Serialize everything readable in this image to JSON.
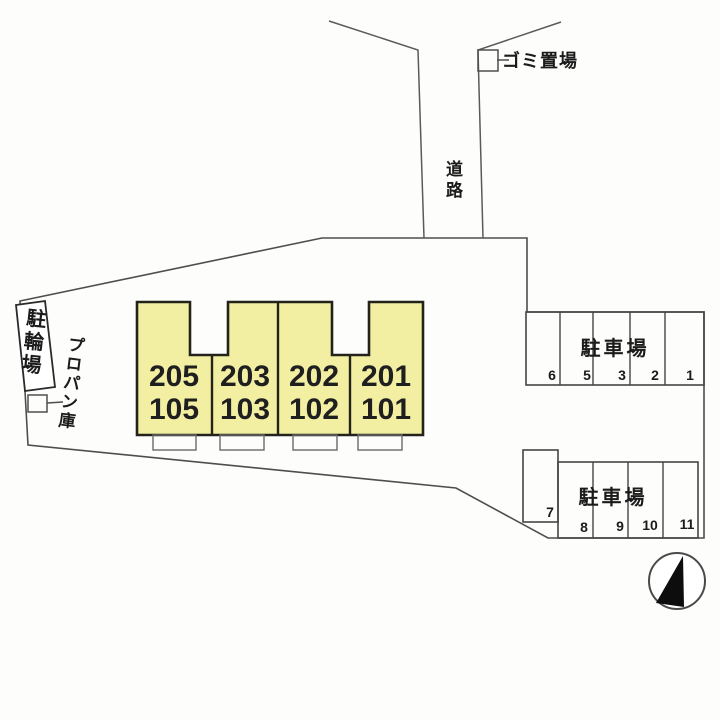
{
  "labels": {
    "road": "道路",
    "garbage_station": "ゴミ置場",
    "bicycle_parking": "駐輪場",
    "propane_storage": "プロパン庫"
  },
  "building": {
    "fill_color": "#f3efa2",
    "units": [
      {
        "upper": "205",
        "lower": "105"
      },
      {
        "upper": "203",
        "lower": "103"
      },
      {
        "upper": "202",
        "lower": "102"
      },
      {
        "upper": "201",
        "lower": "101"
      }
    ]
  },
  "parking_upper": {
    "label": "駐車場",
    "spaces": [
      "6",
      "5",
      "3",
      "2",
      "1"
    ]
  },
  "parking_lower": {
    "label": "駐車場",
    "spaces": [
      "7",
      "8",
      "9",
      "10",
      "11"
    ]
  },
  "compass": {
    "icon": "north-arrow"
  }
}
